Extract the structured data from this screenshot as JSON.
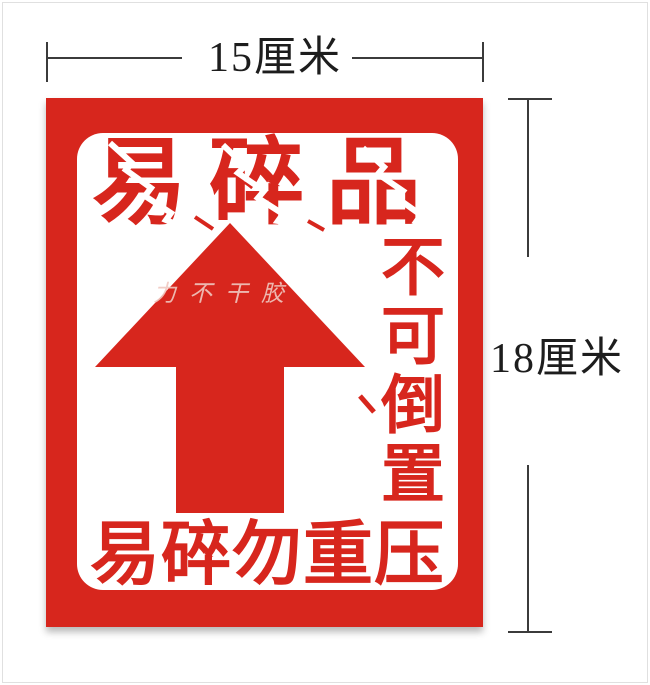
{
  "image": {
    "background": "#ffffff",
    "frame_color": "#e0e0e0"
  },
  "annotations": {
    "width_label": "15厘米",
    "height_label": "18厘米",
    "line_color": "#3b3b3b",
    "text_color": "#1d1d1d"
  },
  "label": {
    "red": "#d7261d",
    "panel_color": "#ffffff",
    "title": "易碎品",
    "side_text": "不可倒置",
    "bottom_text": "易碎勿重压",
    "watermark": "力不干胶",
    "arrow_icon": "up-arrow",
    "watermark_color": "rgba(240,200,192,0.9)"
  }
}
